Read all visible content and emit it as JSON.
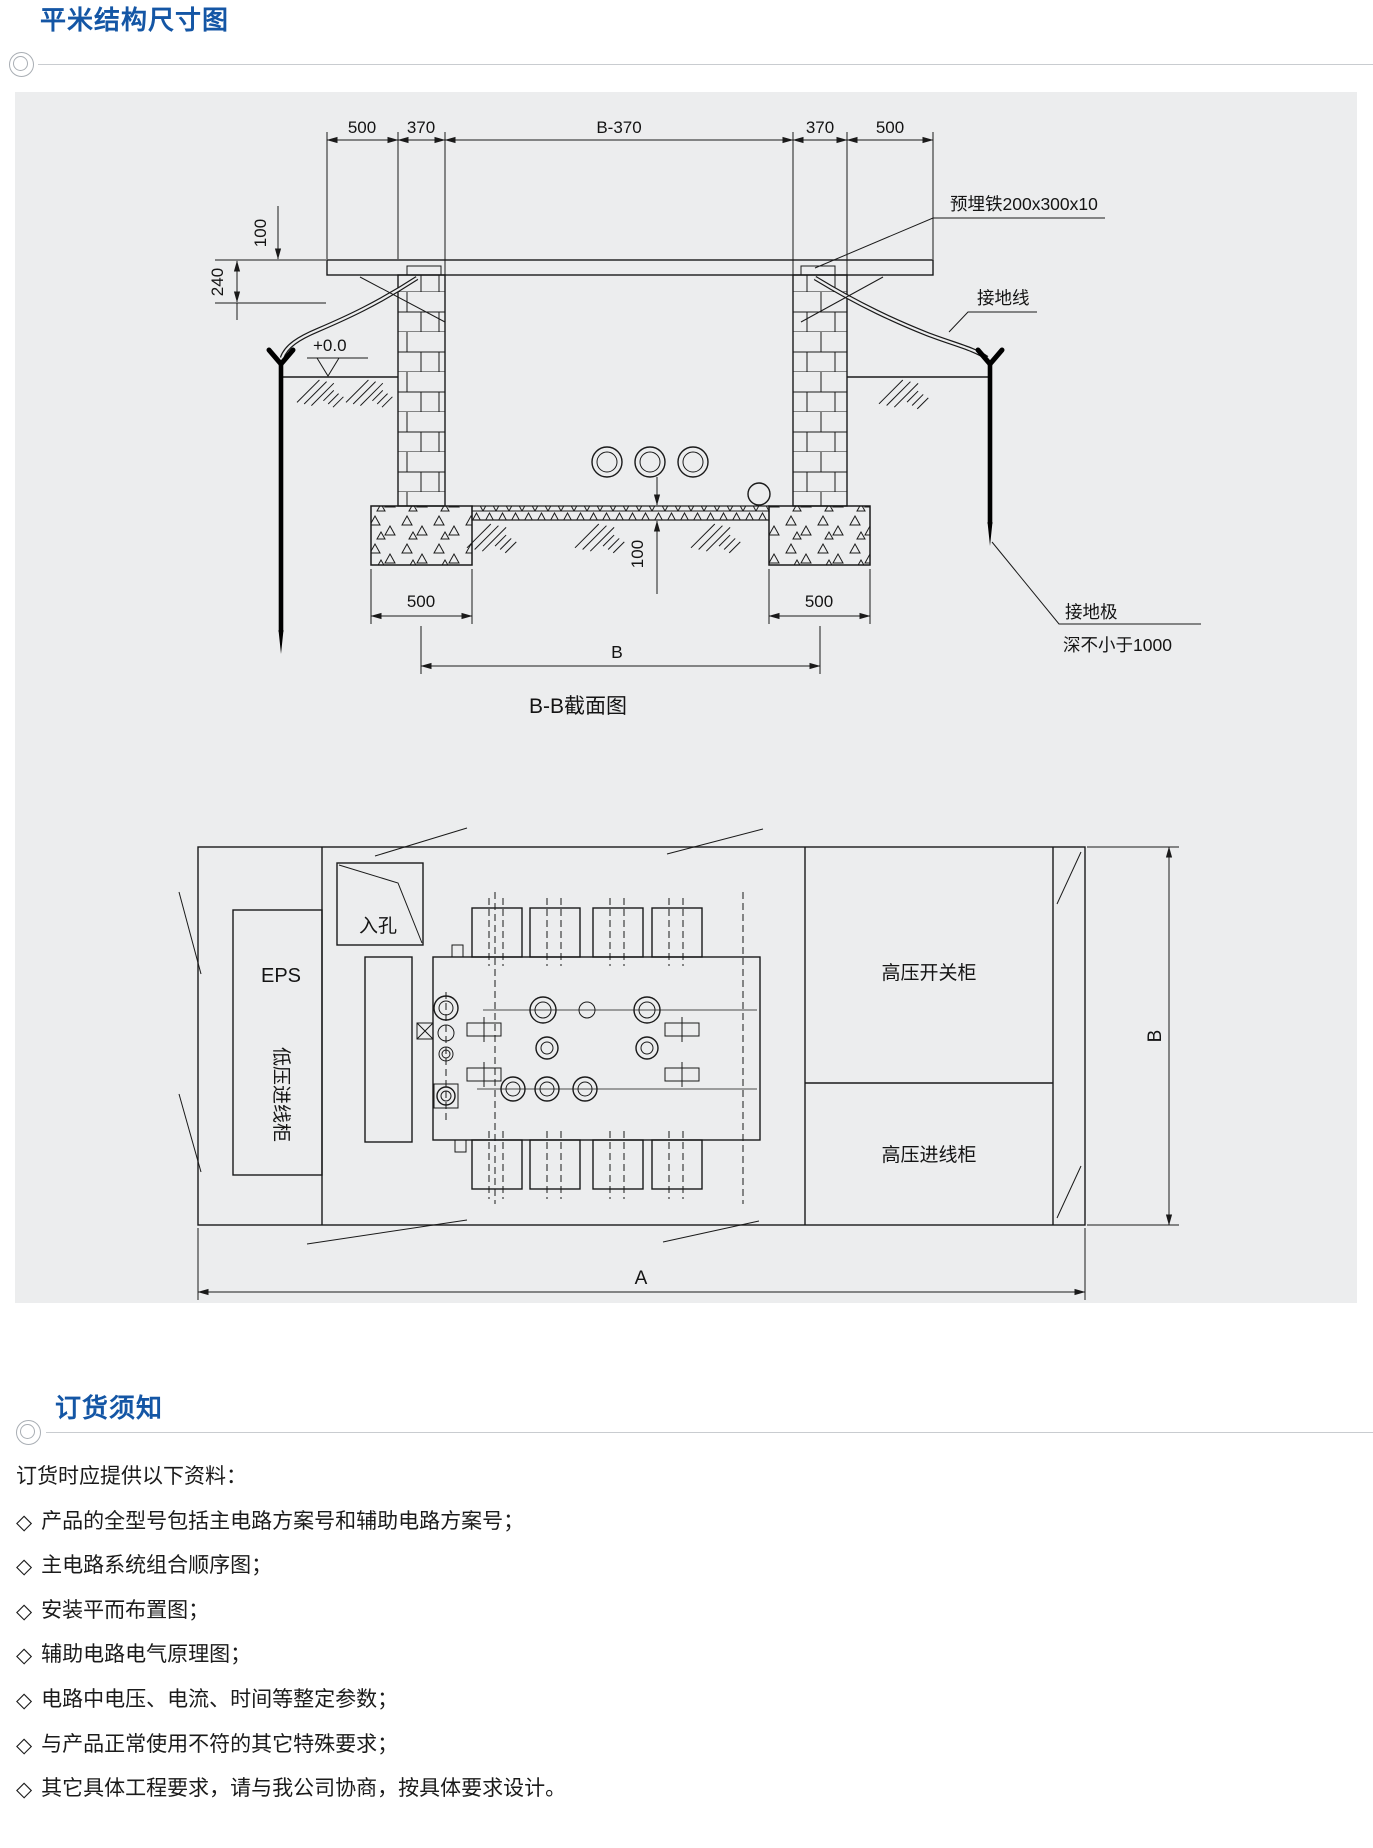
{
  "meta": {
    "accent_blue": "#1456A5",
    "panel_bg": "#ECEDEE",
    "line_color": "#1A1A1A"
  },
  "section1": {
    "title": "平米结构尺寸图"
  },
  "cross_section": {
    "caption": "B-B截面图",
    "dim_top_1": "500",
    "dim_top_2": "370",
    "dim_top_3": "B-370",
    "dim_top_4": "370",
    "dim_top_5": "500",
    "dim_parapet": "100",
    "dim_beam": "240",
    "level": "+0.0",
    "dim_slab": "100",
    "dim_footing_left": "500",
    "dim_footing_right": "500",
    "dim_span": "B",
    "label_embed": "预埋铁200x300x10",
    "label_wire": "接地线",
    "label_rod_line1": "接地极",
    "label_rod_line2": "深不小于1000"
  },
  "plan": {
    "label_manhole": "入孔",
    "label_eps": "EPS",
    "label_lv": "低压进线柜",
    "label_hv_switch": "高压开关柜",
    "label_hv_in": "高压进线柜",
    "dim_a": "A",
    "dim_b": "B"
  },
  "section2": {
    "title": "订货须知"
  },
  "notes": {
    "bullet": "◇",
    "intro": "订货时应提供以下资料：",
    "items": [
      "产品的全型号包括主电路方案号和辅助电路方案号；",
      "主电路系统组合顺序图；",
      "安装平而布置图；",
      "辅助电路电气原理图；",
      "电路中电压、电流、时间等整定参数；",
      "与产品正常使用不符的其它特殊要求；",
      "其它具体工程要求，请与我公司协商，按具体要求设计。"
    ]
  }
}
